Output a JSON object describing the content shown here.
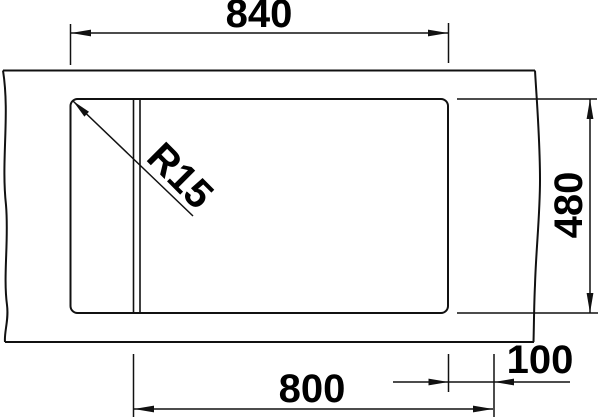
{
  "drawing": {
    "kind": "sink-installation-dimension-drawing",
    "labels": {
      "top_width": "840",
      "right_depth": "480",
      "bottom_width": "800",
      "bottom_offset": "100",
      "corner_radius": "R15"
    },
    "colors": {
      "line": "#111111",
      "text": "#000000",
      "background": "#ffffff"
    }
  }
}
